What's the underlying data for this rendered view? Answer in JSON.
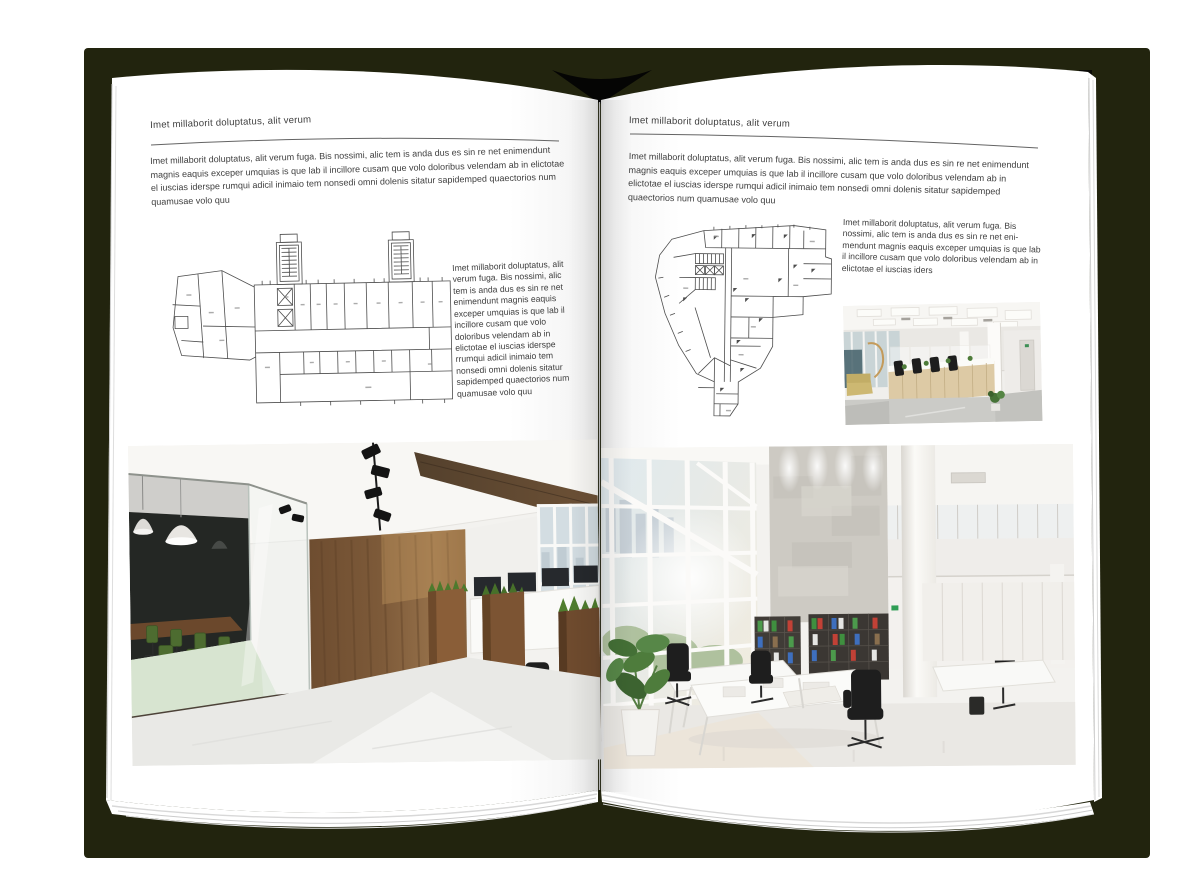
{
  "colors": {
    "backdrop": "#ffffff",
    "book_shadow": "#22240e",
    "page": "#ffffff",
    "text": "#3e3e3e"
  },
  "left_page": {
    "header": "Imet millaborit doluptatus, alit verum",
    "intro": "Imet millaborit doluptatus, alit verum fuga. Bis nossimi, alic tem is anda dus es sin re net enimendunt magnis eaquis exceper umquias is que lab il incillore cusam que volo doloribus velendam ab in elictotae el iuscias iderspe rumqui adicil inimaio tem nonsedi omni dolenis sitatur sapidemped quaectorios num quamusae volo quu",
    "side_text": "Imet millaborit doluptatus, alit verum fuga. Bis nossimi, alic tem is anda dus es sin re net enimendunt magnis eaquis exceper umquias is que lab il incillore cusam que volo doloribus velendam ab in elictotae el iuscias iderspe rrumqui adicil inimaio tem nonsedi omni dolenis sitatur sapidemped quaectorios num quamusae volo quu"
  },
  "right_page": {
    "header": "Imet millaborit doluptatus, alit verum",
    "intro": "Imet millaborit doluptatus, alit verum fuga. Bis nossimi, alic tem is anda dus es sin re net enimendunt magnis eaquis exceper umquias is que lab il incillore cusam que volo doloribus velendam ab in elictotae el iuscias iderspe rumqui adicil inimaio tem nonsedi omni dolenis sitatur sapidemped quaectorios num quamusae volo quu",
    "side_text": "Imet millaborit doluptatus, alit verum fuga. Bis nossimi, alic tem is anda dus es sin re net eni-mendunt magnis eaquis exceper umquias is que lab il incillore cusam que volo doloribus velendam ab in elictotae el iuscias iders"
  }
}
